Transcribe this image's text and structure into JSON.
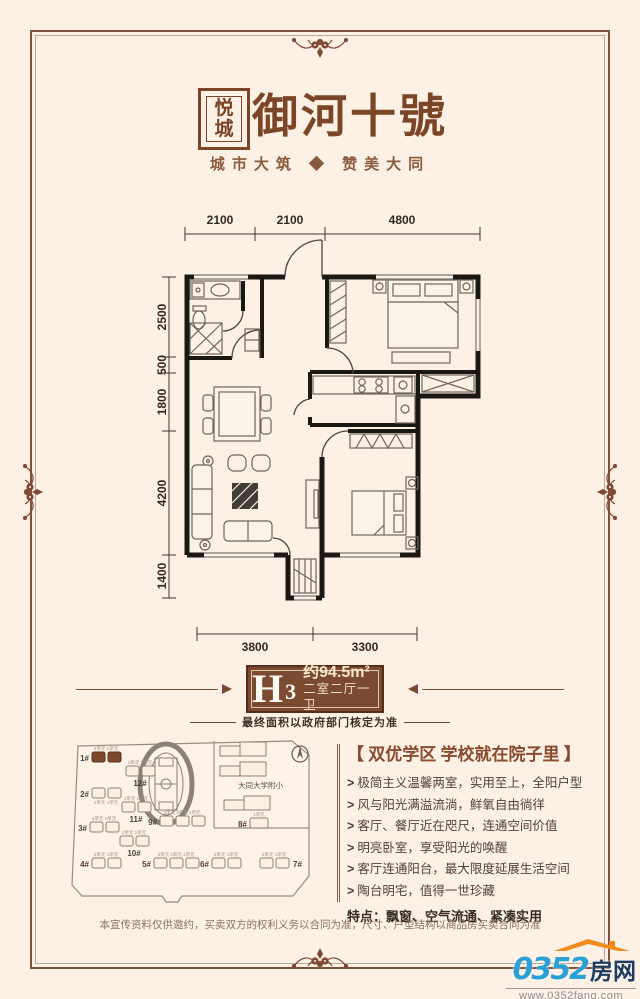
{
  "header": {
    "seal_char1": "悦",
    "seal_char2": "城",
    "title": "御河十號",
    "subtitle": "城市大筑 ◆ 赞美大同"
  },
  "floorplan": {
    "dims_top": [
      "2100",
      "2100",
      "4800"
    ],
    "dims_left": [
      "2500",
      "500",
      "1800",
      "4200",
      "1400"
    ],
    "dims_bottom": [
      "3800",
      "3300"
    ]
  },
  "unit_badge": {
    "model_letter": "H",
    "model_number": "3",
    "area_text": "约94.5m²",
    "layout_text": "二室二厅一卫",
    "note": "最终面积以政府部门核定为准"
  },
  "sitemap": {
    "school_label": "大同大学附小",
    "unit_label_2": "2单元 1单元",
    "unit_label_3": "3单元 2单元 1单元",
    "unit_label_1": "1单元",
    "buildings": [
      "1#",
      "2#",
      "3#",
      "4#",
      "5#",
      "6#",
      "7#",
      "8#",
      "9#",
      "10#",
      "11#",
      "12#"
    ]
  },
  "selling_points": {
    "headline": "【 双优学区  学校就在院子里 】",
    "bullet_prefix": ">",
    "bullets": [
      "极简主义温馨两室，实用至上，全阳户型",
      "风与阳光满溢流淌，鲜氧自由徜徉",
      "客厅、餐厅近在咫尺，连通空间价值",
      "明亮卧室，享受阳光的唤醒",
      "客厅连通阳台，最大限度延展生活空间",
      "陶台明宅，值得一世珍藏"
    ],
    "features": "特点：飘窗、空气流通、紧凑实用"
  },
  "footer": {
    "disclaimer": "本宣传资料仅供邀约，买卖双方的权利义务以合同为准，尺寸、户型结构以商品房买卖合同为准"
  },
  "logo": {
    "number": "0352",
    "name": "房网",
    "url": "www.0352fang.com"
  },
  "colors": {
    "background": "#fdf0e4",
    "frame_brown": "#80503c",
    "title_brown": "#7b4527",
    "badge_brown": "#7c4a31",
    "accent_blue": "#2ba0d6",
    "accent_orange": "#f08c1e"
  }
}
